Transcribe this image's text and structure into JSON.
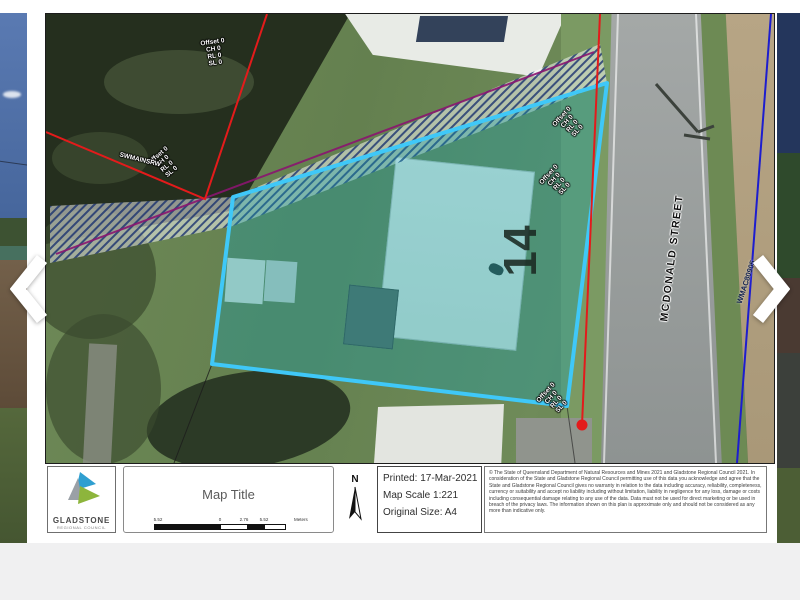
{
  "viewer": {
    "prev_tooltip": "Previous image",
    "next_tooltip": "Next image"
  },
  "map": {
    "street_label": "MCDONALD STREET",
    "lot_number": "14",
    "water_main_id": "WMAC80905",
    "stormwater_label": "SWMAINSRW",
    "offset_lines": [
      "Offset 0",
      "CH 0",
      "RL 0",
      "SL 0"
    ]
  },
  "footer": {
    "logo_title": "GLADSTONE",
    "logo_subtitle": "REGIONAL COUNCIL",
    "map_title": "Map Title",
    "scale_labels": {
      "left": "5.52",
      "zero": "0",
      "mid": "2.76",
      "right": "5.52",
      "unit": "Meters"
    },
    "north": "N",
    "printed": "Printed: 17-Mar-2021",
    "map_scale": "Map Scale 1:221",
    "original_size": "Original Size: A4",
    "copyright": "© The State of Queensland Department of Natural Resources and Mines 2021 and Gladstone Regional Council 2021. In consideration of the State and Gladstone Regional Council permitting use of this data you acknowledge and agree that the State and Gladstone Regional Council gives no warranty in relation to the data including accuracy, reliability, completeness, currency or suitability and accept no liability including without limitation, liability in negligence for any loss, damage or costs including consequential damage relating to any use of the data. Data must not be used for direct marketing or be used in breach of the privacy laws. The information shown on this plan is approximate only and should not be considered as any more than indicative only."
  },
  "colors": {
    "parcel_stroke": "#3fc8f8",
    "parcel_fill": "rgba(14,160,180,0.33)",
    "survey_red": "#e31b1b",
    "water_blue": "#1d1dcf",
    "easement_magenta": "#8a1570"
  }
}
